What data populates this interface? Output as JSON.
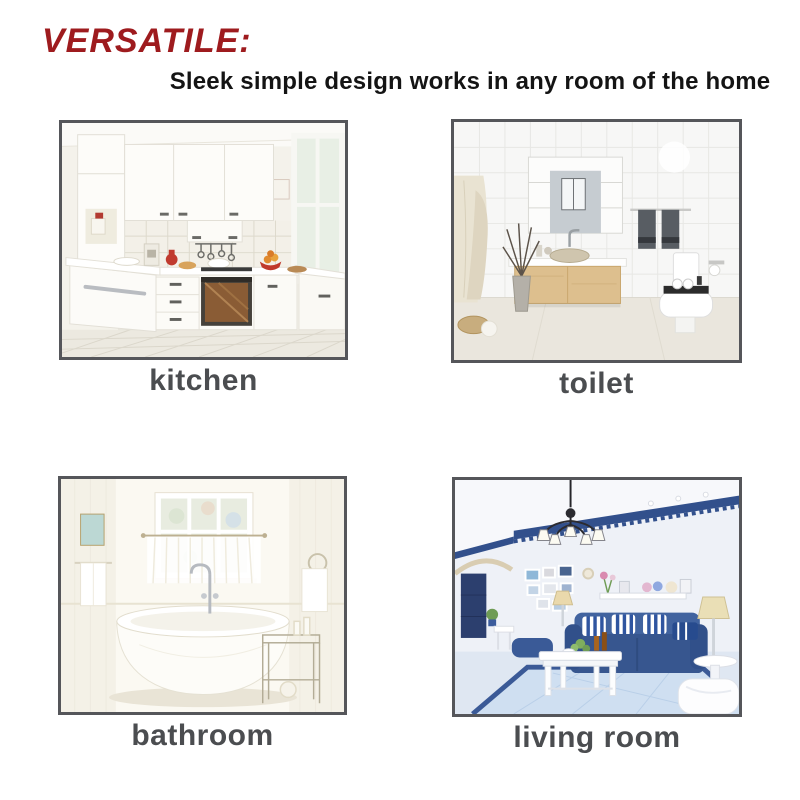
{
  "header": {
    "title": "VERSATILE:",
    "subtitle": "Sleek simple design works in any room of the home"
  },
  "rooms": [
    {
      "label": "kitchen",
      "photo": "white-kitchen-photo"
    },
    {
      "label": "toilet",
      "photo": "bathroom-vanity-toilet-photo"
    },
    {
      "label": "bathroom",
      "photo": "freestanding-bathtub-photo"
    },
    {
      "label": "living room",
      "photo": "blue-sofa-living-room-photo"
    }
  ],
  "colors": {
    "title": "#9e1b1e",
    "subtitle_text": "#141414",
    "caption_text": "#4b4d50",
    "photo_frame": "#55565a",
    "background": "#ffffff"
  }
}
